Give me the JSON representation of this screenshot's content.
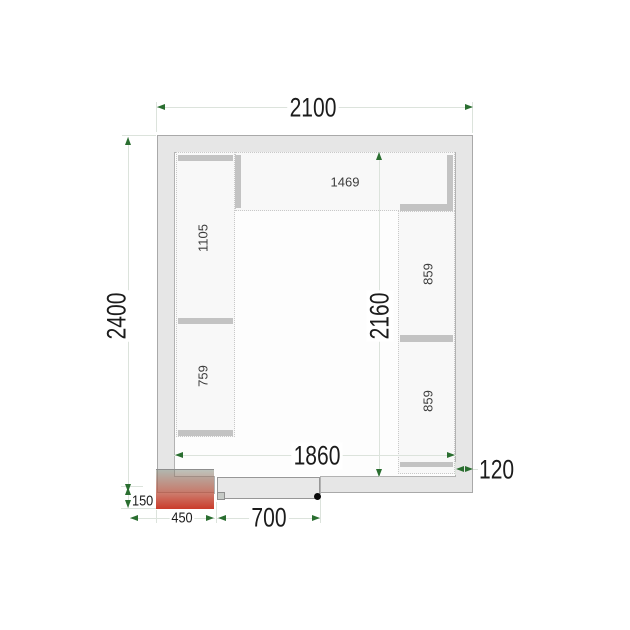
{
  "diagram": {
    "title": "cold room floor plan",
    "dimensions": {
      "outer_width": "2100",
      "outer_depth": "2400",
      "inner_depth": "2160",
      "inner_width": "1860",
      "wall_thickness": "120",
      "door_width": "700",
      "unit_width": "450",
      "unit_protrusion": "150"
    },
    "shelves": {
      "top": "1469",
      "left_upper": "1105",
      "left_lower": "759",
      "right_upper": "859",
      "right_lower": "859"
    },
    "colors": {
      "dim_line": "#dce3dc",
      "arrow_green": "#2a6e30",
      "wall_fill": "#e6e6e6",
      "shelf_fill": "#f8f8f8",
      "shelf_bar": "#c3c3c3",
      "unit_red": "#cb3a28",
      "door_fill": "#e8e8e8",
      "handle_black": "#0a0a0a"
    }
  }
}
